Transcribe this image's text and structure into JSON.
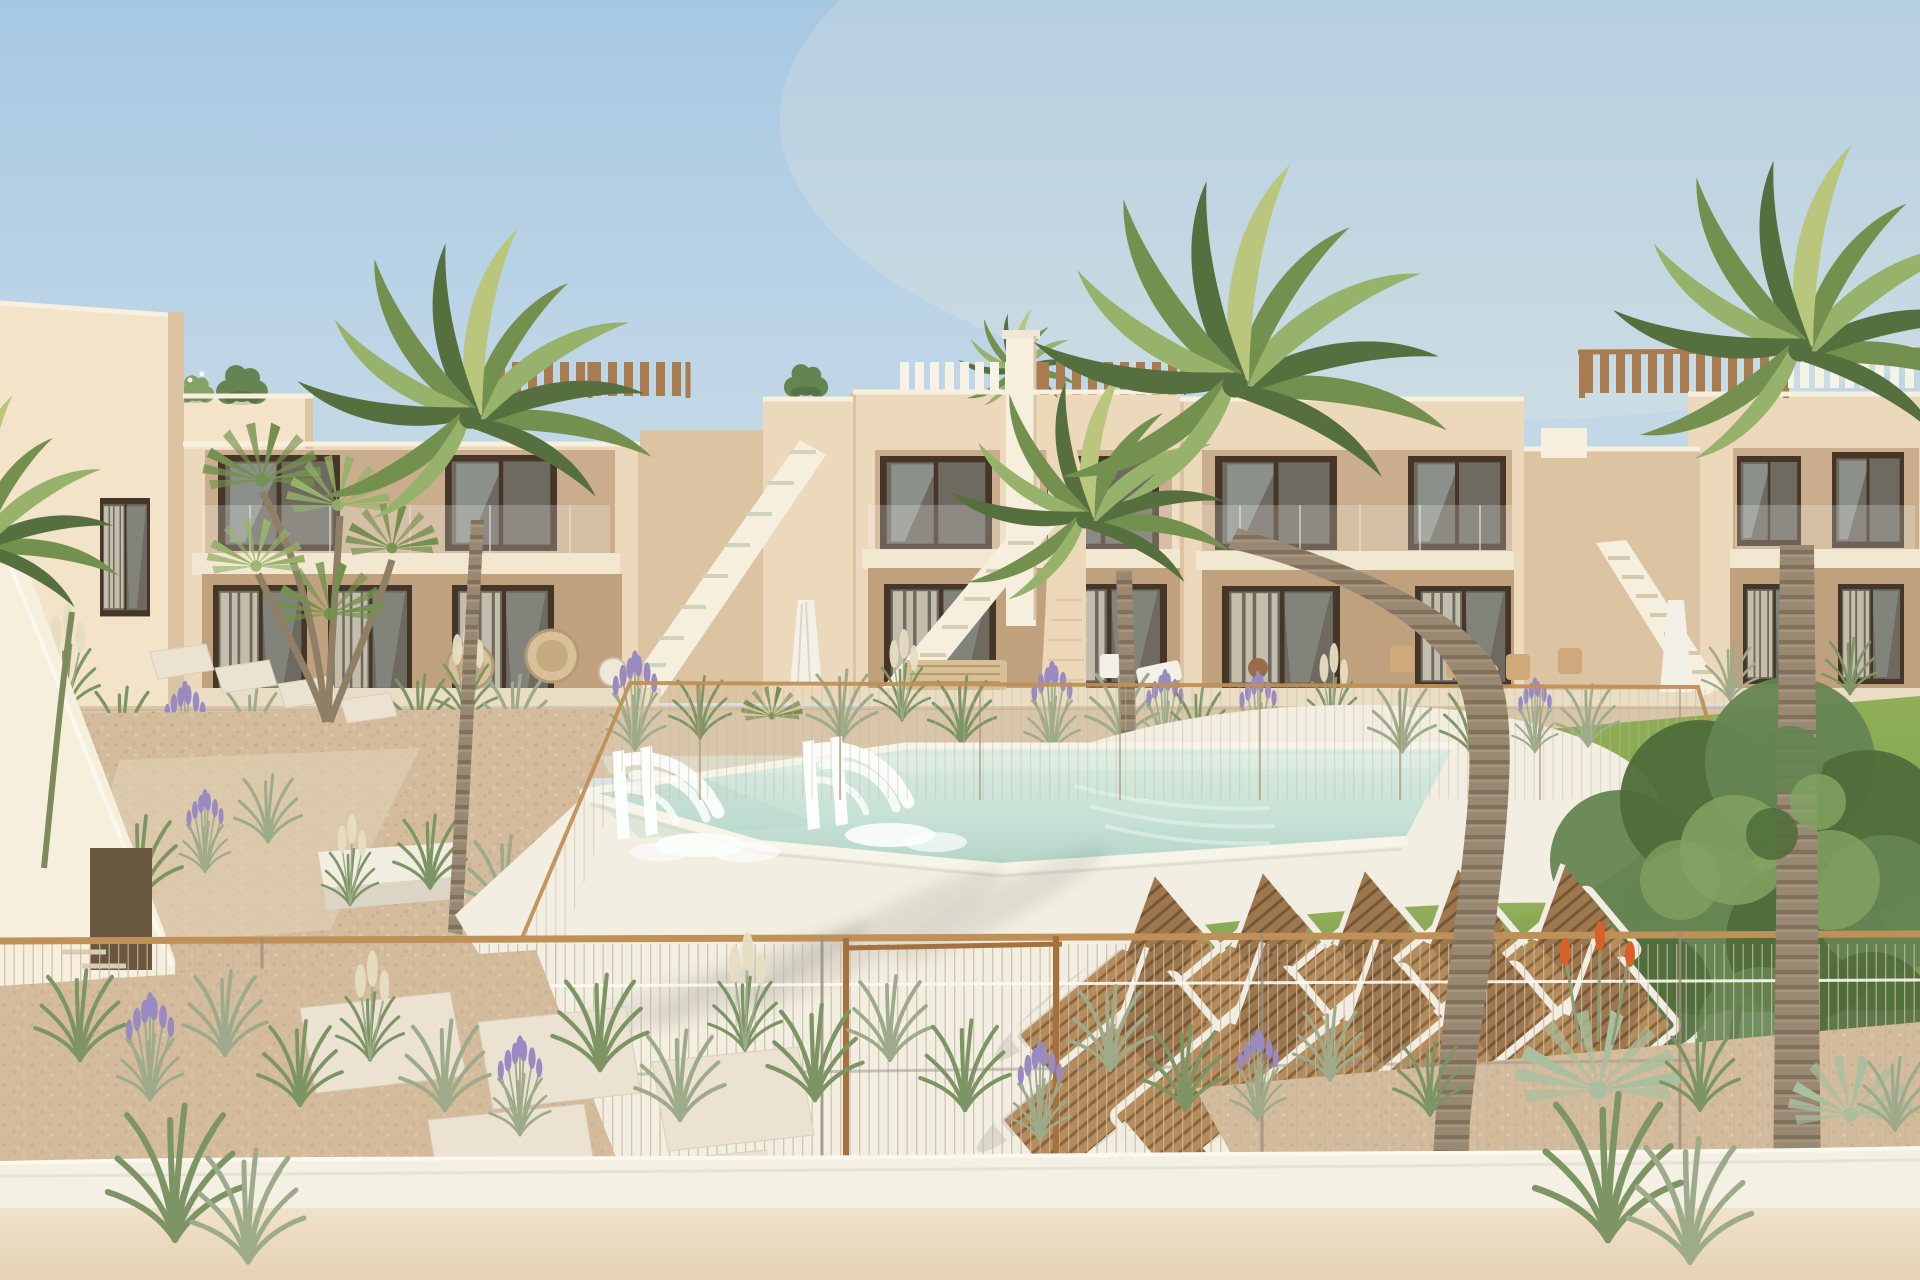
{
  "scene": {
    "label": "Sunny exterior render of a modern two-storey beige apartment complex with roof pergolas and external staircases, communal pool with two water jets, two rows of wooden sun loungers, palm trees, lavender and grass landscaping, lawn with a leafy tree, wire mesh fences and a foreground wall",
    "counts": {
      "apartment_blocks": 5,
      "sun_loungers": 10,
      "water_jets": 2,
      "palm_trees": 6,
      "staircases": 4,
      "parasols": 2,
      "roof_pergolas": 4
    }
  },
  "palette": {
    "sky-top": "#a7c8e3",
    "sky-mid": "#c9dce8",
    "sky-low": "#e7eae6",
    "sky-horizon": "#f4efe6",
    "glow": "#fff3da",
    "wall-lit": "#ecd8ba",
    "wall-light": "#f3e3c8",
    "wall-shade": "#dcc3a2",
    "wall-recess": "#c9ad8c",
    "wall-recess-deep": "#bfa17d",
    "white-warm": "#f6efde",
    "cream-slab": "#f2e7d1",
    "parapet": "#f8f0de",
    "terrace": "#e9ddc5",
    "frame-dark": "#463627",
    "glass-dark": "#6e6a60",
    "glass-sky": "#aab5b3",
    "curtain": "#d5ccba",
    "wood-pergola": "#a87c4f",
    "wood-rail": "#bf9058",
    "wire": "#c8b99e",
    "gate": "#a6713d",
    "trunk": "#998872",
    "trunk-ring": "#7a6a54",
    "trunk-green": "#7e8a5c",
    "palm-dark": "#566f3e",
    "palm-mid": "#74904f",
    "palm-light": "#97b26b",
    "palm-pale": "#bac67c",
    "grass-sage": "#9dab8b",
    "grass-green": "#7d9465",
    "pampas": "#e7dec2",
    "lavender": "#998bc1",
    "tree-dark": "#4e6d3a",
    "tree-mid": "#648551",
    "tree-light": "#83a263",
    "pool-far": "#daebe1",
    "pool-mid": "#c8e2d6",
    "pool-deep": "#b5d5c8",
    "pool-lip": "#f7f4ea",
    "deck": "#f2eee1",
    "deck-shade": "#d8d3c3",
    "sand": "#d9c5a9",
    "gravel": "#d3bb9c",
    "slab": "#ebe2d1",
    "lawn": "#8fae57",
    "lawn-dark": "#78994a",
    "lounger-wood": "#b78c5c",
    "lounger-slat": "#8a653c",
    "lounger-frame": "#f2ede2",
    "jet": "#fcfefc",
    "ledge": "#f5f0e4",
    "wall-front-top": "#f1e2cb",
    "wall-front-bottom": "#e5d1b3",
    "shadow": "#5b5e55",
    "aloe": "#a9bfa0",
    "aloe-flower": "#d8602a",
    "furniture-wood": "#d7c095",
    "furniture-white": "#f3f0e8",
    "table-dark": "#5a4a38"
  }
}
